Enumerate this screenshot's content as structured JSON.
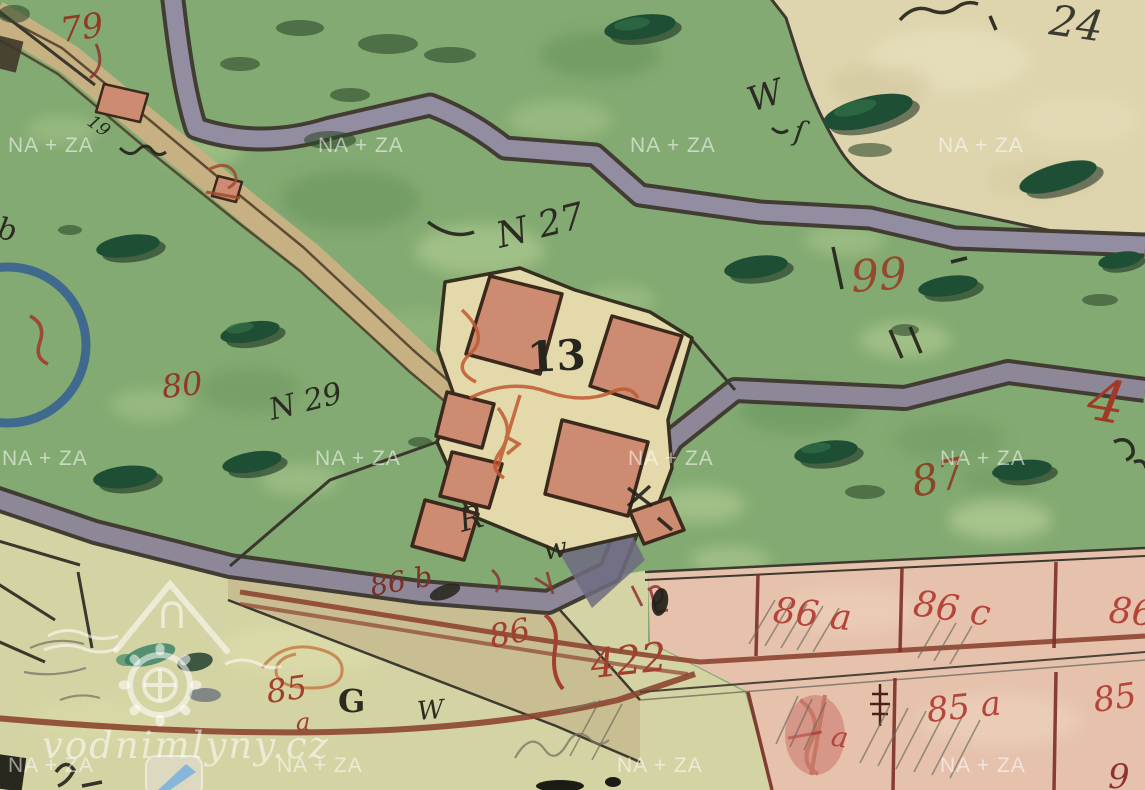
{
  "watermark": {
    "text": "NA + ZA"
  },
  "logo": {
    "text": "vodnimlyny.cz"
  },
  "map": {
    "kind": "historical hand-drawn cadastral map scan",
    "house_number": "13",
    "palette": {
      "meadow_green": "#83aa72",
      "paper_beige": "#ded4ad",
      "parcel_pink": "#e6c2ad",
      "building_pink": "#cd8b72",
      "road_slate": "#938da1",
      "path_tan": "#c7b183",
      "ink_black": "#2b2b22",
      "ink_red": "#9c4b2d",
      "ink_crimson": "#b5453a",
      "circle_blue": "#2f5a94"
    },
    "labels": [
      {
        "text": "79",
        "color": "#8f3a26"
      },
      {
        "text": "19",
        "color": "#2b2b22"
      },
      {
        "text": "W",
        "color": "#2b2b22"
      },
      {
        "text": "ſ",
        "color": "#2b2b22"
      },
      {
        "text": "24",
        "color": "#3a3a30"
      },
      {
        "text": "N 27",
        "color": "#2b2b22"
      },
      {
        "text": "99",
        "color": "#96482c"
      },
      {
        "text": "80",
        "color": "#8f3a26"
      },
      {
        "text": "N 29",
        "color": "#2b2b22"
      },
      {
        "text": "13",
        "color": "#26261e"
      },
      {
        "text": "87",
        "color": "#8a4626"
      },
      {
        "text": "4",
        "color": "#a03a26"
      },
      {
        "text": "86 a",
        "color": "#b5453a"
      },
      {
        "text": "86 c",
        "color": "#b5453a"
      },
      {
        "text": "86",
        "color": "#b5453a"
      },
      {
        "text": "86 b",
        "color": "#7c2f26"
      },
      {
        "text": "86",
        "color": "#a2402f"
      },
      {
        "text": "422",
        "color": "#a2402f"
      },
      {
        "text": "85",
        "color": "#a2402f"
      },
      {
        "text": "a",
        "color": "#a2402f"
      },
      {
        "text": "G",
        "color": "#2b2b22"
      },
      {
        "text": "W",
        "color": "#2b2b22"
      },
      {
        "text": "85 a",
        "color": "#b5453a"
      },
      {
        "text": "85",
        "color": "#b5453a"
      },
      {
        "text": "9",
        "color": "#8e3330"
      },
      {
        "text": "b",
        "color": "#2b2b22"
      },
      {
        "text": "a",
        "color": "#b5453a"
      },
      {
        "text": "R",
        "color": "#2b2b22"
      },
      {
        "text": "w",
        "color": "#2b2b22"
      }
    ]
  }
}
